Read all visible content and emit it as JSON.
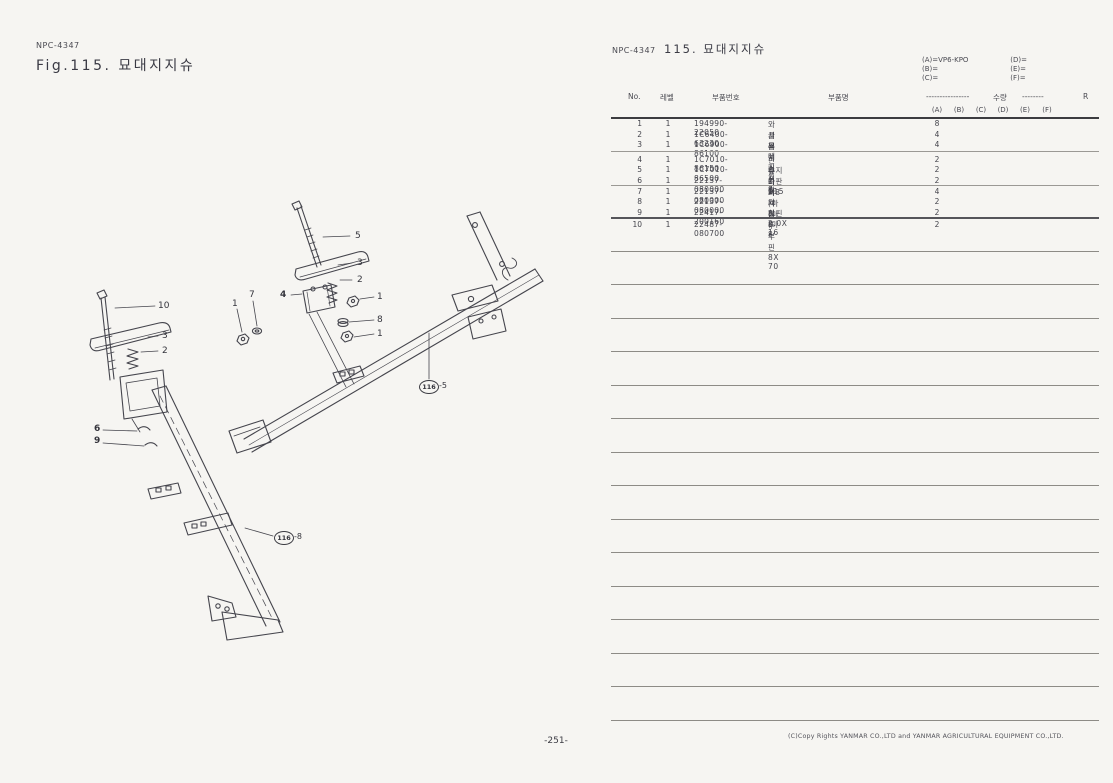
{
  "left_header": {
    "code": "NPC-4347",
    "fig_title": "Fig.115.  묘대지지슈"
  },
  "right_header": {
    "code": "NPC-4347",
    "title": "115.  묘대지지슈"
  },
  "model_codes": {
    "a": "(A)=VP6-KPO",
    "b": "(B)=",
    "c": "(C)=",
    "d": "(D)=",
    "e": "(E)=",
    "f": "(F)="
  },
  "table": {
    "headers": {
      "no": "No.",
      "level": "레벨",
      "part_number": "부품번호",
      "part_name": "부품명",
      "dashes_left": "----------------",
      "qty": "수량",
      "dashes_right": "--------",
      "r": "R"
    },
    "qty_columns": [
      "(A)",
      "(B)",
      "(C)",
      "(D)",
      "(E)",
      "(F)"
    ],
    "rows": [
      {
        "no": "1",
        "level": "1",
        "part_number": "194990-22050",
        "part_name": "와셔붙이너트 8",
        "qty_a": "8"
      },
      {
        "no": "2",
        "level": "1",
        "part_number": "1C6400-63230",
        "part_name": "클러치스프링",
        "qty_a": "4"
      },
      {
        "no": "3",
        "level": "1",
        "part_number": "1C6900-86100",
        "part_name": "묘대지지슈",
        "qty_a": "4"
      },
      {
        "no": "4",
        "level": "1",
        "part_number": "1C7010-86150",
        "part_name": "핀홀더 M8",
        "qty_a": "2"
      },
      {
        "no": "5",
        "level": "1",
        "part_number": "1C7010-86500",
        "part_name": "슈지지판 115",
        "qty_a": "2"
      },
      {
        "no": "6",
        "level": "1",
        "part_number": "22137-080000",
        "part_name": "와셔(마 8",
        "qty_a": "2"
      },
      {
        "no": "7",
        "level": "1",
        "part_number": "22137-080000",
        "part_name": "와셔(마 8",
        "qty_a": "4"
      },
      {
        "no": "8",
        "level": "1",
        "part_number": "22137-080000",
        "part_name": "와셔(마 8",
        "qty_a": "2"
      },
      {
        "no": "9",
        "level": "1",
        "part_number": "22417-200160",
        "part_name": "할핀 2.0X 16",
        "qty_a": "2"
      },
      {
        "no": "10",
        "level": "1",
        "part_number": "22487-080700",
        "part_name": "두부핀 8X 70",
        "qty_a": "2"
      }
    ]
  },
  "diagram": {
    "callouts": [
      {
        "text": "5",
        "x": 355,
        "y": 231
      },
      {
        "text": "3",
        "x": 357,
        "y": 258
      },
      {
        "text": "2",
        "x": 357,
        "y": 275
      },
      {
        "text": "1",
        "x": 377,
        "y": 292
      },
      {
        "text": "8",
        "x": 377,
        "y": 315
      },
      {
        "text": "1",
        "x": 377,
        "y": 329
      },
      {
        "text": "4",
        "x": 280,
        "y": 290,
        "bold": true
      },
      {
        "text": "7",
        "x": 249,
        "y": 290
      },
      {
        "text": "1",
        "x": 232,
        "y": 299
      },
      {
        "text": "10",
        "x": 158,
        "y": 301
      },
      {
        "text": "3",
        "x": 162,
        "y": 331
      },
      {
        "text": "2",
        "x": 162,
        "y": 346
      },
      {
        "text": "6",
        "x": 94,
        "y": 424,
        "bold": true
      },
      {
        "text": "9",
        "x": 94,
        "y": 436,
        "bold": true
      }
    ],
    "refs": [
      {
        "label": "116",
        "suffix": "-5",
        "x": 419,
        "y": 380
      },
      {
        "label": "116",
        "suffix": "-8",
        "x": 274,
        "y": 531
      }
    ]
  },
  "footer": {
    "page_number": "-251-",
    "copyright": "(C)Copy Rights  YANMAR CO.,LTD and YANMAR AGRICULTURAL EQUIPMENT CO.,LTD."
  }
}
